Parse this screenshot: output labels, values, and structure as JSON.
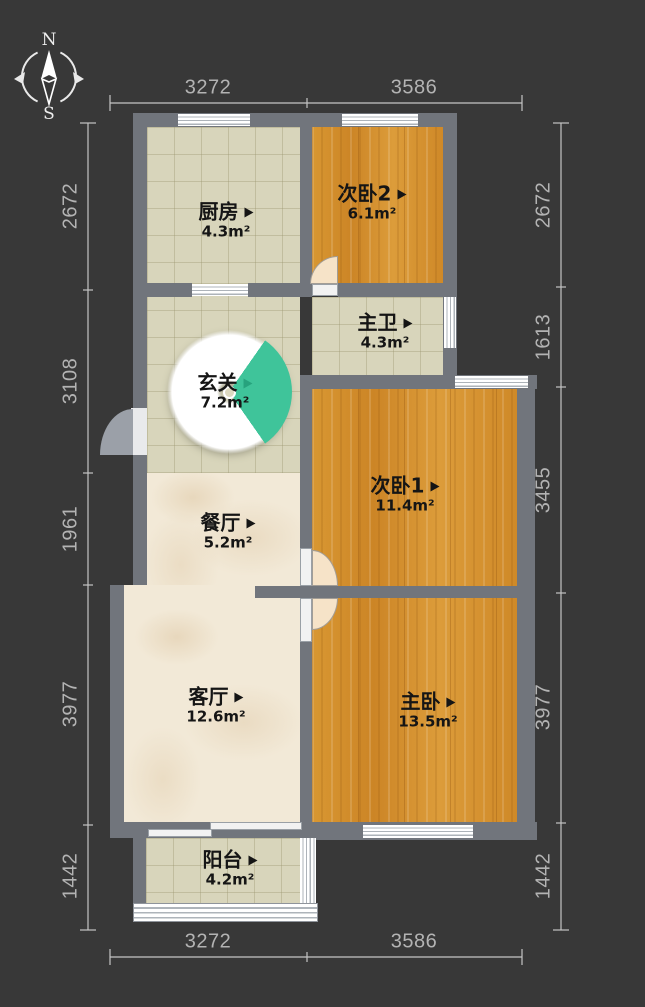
{
  "plan": {
    "compass": {
      "north": "N",
      "south": "S"
    },
    "rooms": [
      {
        "id": "kitchen",
        "name": "厨房",
        "area": "4.3m²"
      },
      {
        "id": "bedroom2",
        "name": "次卧2",
        "area": "6.1m²"
      },
      {
        "id": "master-bath",
        "name": "主卫",
        "area": "4.3m²"
      },
      {
        "id": "entry",
        "name": "玄关",
        "area": "7.2m²"
      },
      {
        "id": "bedroom1",
        "name": "次卧1",
        "area": "11.4m²"
      },
      {
        "id": "dining",
        "name": "餐厅",
        "area": "5.2m²"
      },
      {
        "id": "living",
        "name": "客厅",
        "area": "12.6m²"
      },
      {
        "id": "master-bedroom",
        "name": "主卧",
        "area": "13.5m²"
      },
      {
        "id": "balcony",
        "name": "阳台",
        "area": "4.2m²"
      }
    ],
    "dimensions": {
      "top": [
        "3272",
        "3586"
      ],
      "bottom": [
        "3272",
        "3586"
      ],
      "left": [
        "2672",
        "3108",
        "1961",
        "3977",
        "1442"
      ],
      "right": [
        "2672",
        "1613",
        "3455",
        "3977",
        "1442"
      ]
    },
    "colors": {
      "background": "#383838",
      "wall": "#71757c",
      "wood_floor": "#d28e2c",
      "tile_floor": "#d8d5bb",
      "marble_floor": "#f2e9d7",
      "entry_fan": "#3fc49a",
      "dimension_text": "#b3b3b3"
    }
  }
}
